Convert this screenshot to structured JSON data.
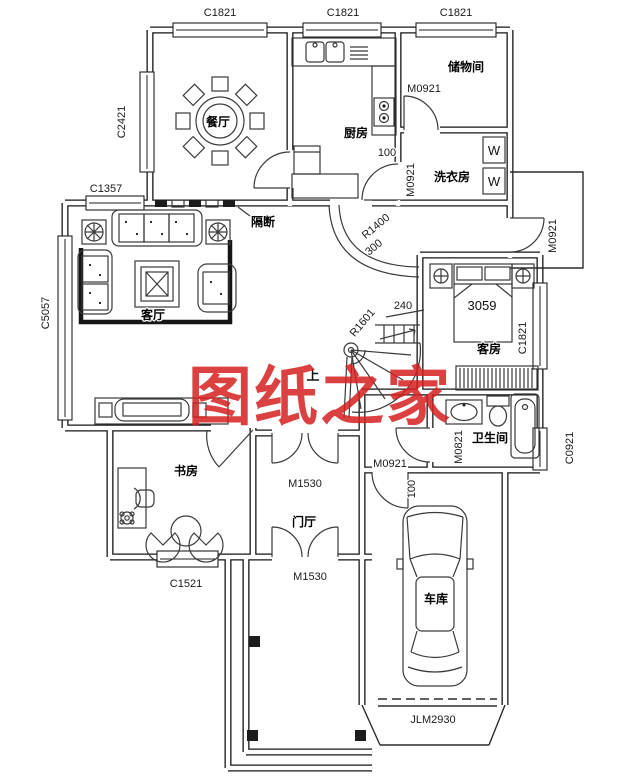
{
  "watermark": "图纸之家",
  "colors": {
    "watermark_red": "#d62020",
    "line": "#161616"
  },
  "rooms": {
    "dining": "餐厅",
    "kitchen": "厨房",
    "storage": "储物间",
    "laundry": "洗衣房",
    "living": "客厅",
    "guest": "客房",
    "bathroom": "卫生间",
    "study": "书房",
    "hall": "门厅",
    "garage": "车库"
  },
  "annotations": {
    "partition": "隔断",
    "up": "上"
  },
  "windows": {
    "top_dining": "C1821",
    "top_kitchen": "C1821",
    "top_storage": "C1821",
    "dining_left": "C2421",
    "living_top": "C1357",
    "living_left": "C5057",
    "study_bottom": "C1521",
    "guest_right": "C1821",
    "bath_right": "C0921"
  },
  "doors": {
    "storage": "M0921",
    "laundry": "M0921",
    "terrace": "M0921",
    "garage_side": "M0921",
    "hall_front": "M1530",
    "hall_porch": "M1530",
    "bathroom": "M0821",
    "garage_main": "JLM2930"
  },
  "dimensions": {
    "kitchen_gap": "100",
    "garage_gap": "100",
    "stair_radius_large": "R1400",
    "stair_width": "300",
    "stair_tread": "240",
    "stair_radius_small": "R1601",
    "bed_length": "3059"
  },
  "appliances": {
    "washer_top": "W",
    "washer_bottom": "W"
  }
}
